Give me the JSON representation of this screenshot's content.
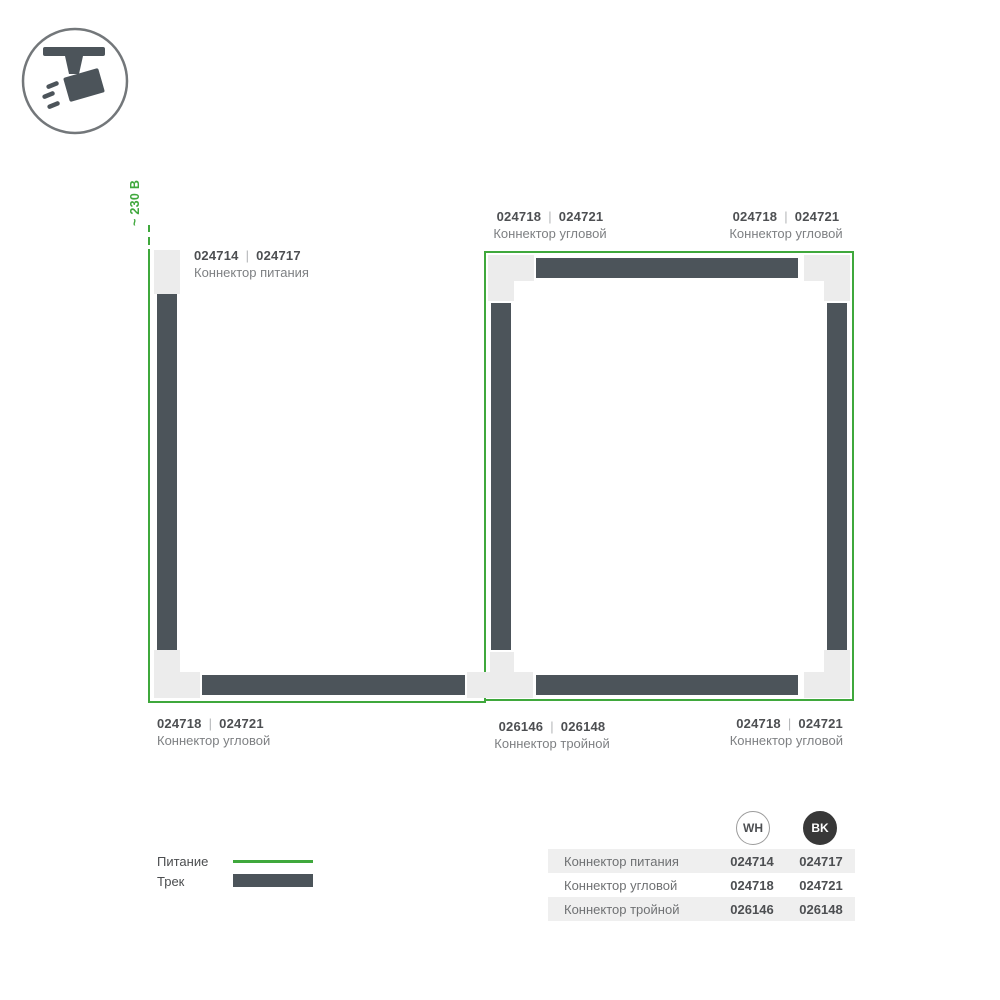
{
  "colors": {
    "power_line_green": "#3fa83c",
    "track_dark": "#4c545a",
    "connector_light": "#ececec",
    "code_text": "#4d4f52",
    "label_text": "#7e8083",
    "row_background": "#efefef",
    "bk_circle_fill": "#383838"
  },
  "logo": {
    "icon": "track-spotlight-icon"
  },
  "diagram": {
    "voltage": "~ 230 В",
    "separator": "|",
    "labels": [
      {
        "wh": "024714",
        "bk": "024717",
        "name": "Коннектор питания"
      },
      {
        "wh": "024718",
        "bk": "024721",
        "name": "Коннектор угловой"
      },
      {
        "wh": "024718",
        "bk": "024721",
        "name": "Коннектор угловой"
      },
      {
        "wh": "024718",
        "bk": "024721",
        "name": "Коннектор угловой"
      },
      {
        "wh": "026146",
        "bk": "026148",
        "name": "Коннектор тройной"
      },
      {
        "wh": "024718",
        "bk": "024721",
        "name": "Коннектор угловой"
      }
    ]
  },
  "legend": {
    "power": "Питание",
    "track": "Трек"
  },
  "table": {
    "col_wh": "WH",
    "col_bk": "BK",
    "rows": [
      {
        "name": "Коннектор питания",
        "wh": "024714",
        "bk": "024717"
      },
      {
        "name": "Коннектор угловой",
        "wh": "024718",
        "bk": "024721"
      },
      {
        "name": "Коннектор тройной",
        "wh": "026146",
        "bk": "026148"
      }
    ]
  }
}
